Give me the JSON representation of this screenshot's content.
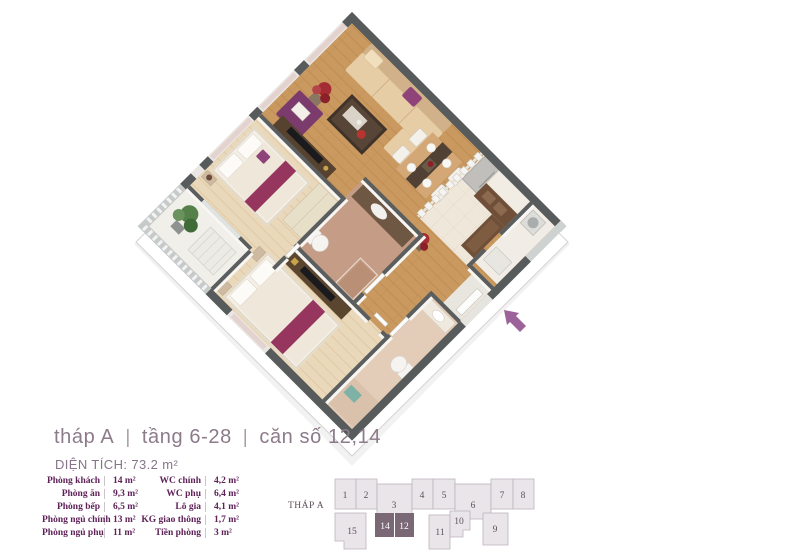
{
  "header": {
    "tower": "tháp A",
    "floors": "tầng 6-28",
    "unit": "căn số 12,14",
    "separator": "|",
    "area_title": "DIỆN TÍCH: 73.2 m²"
  },
  "room_table": {
    "left": [
      {
        "name": "Phòng khách",
        "area": "14 m²"
      },
      {
        "name": "Phòng ăn",
        "area": "9,3 m²"
      },
      {
        "name": "Phòng bếp",
        "area": "6,5 m²"
      },
      {
        "name": "Phòng ngủ chính",
        "area": "13 m²"
      },
      {
        "name": "Phòng ngủ phụ",
        "area": "11 m²"
      }
    ],
    "right": [
      {
        "name": "WC chính",
        "area": "4,2 m²"
      },
      {
        "name": "WC phụ",
        "area": "6,4 m²"
      },
      {
        "name": "Lô gia",
        "area": "4,1 m²"
      },
      {
        "name": "KG giao thông",
        "area": "1,7 m²"
      },
      {
        "name": "Tiền phòng",
        "area": "3 m²"
      }
    ]
  },
  "building_map": {
    "label": "THÁP A",
    "top_row": [
      "1",
      "2",
      "3",
      "4",
      "5",
      "6",
      "7",
      "8"
    ],
    "bottom_row": [
      "15",
      "14",
      "12",
      "11",
      "10",
      "9"
    ],
    "highlighted_units": [
      "14",
      "12"
    ]
  },
  "floorplan": {
    "entrance_arrow_color": "#9c629a",
    "wall_color": "#575b5b",
    "wood_floor_color": "#c9995f",
    "bedroom_floor_color": "#ead8ba",
    "accent_purple": "#8e4379",
    "highlight_unit_color": "#7b6877",
    "unit_fill_color": "#e9e5e9"
  }
}
